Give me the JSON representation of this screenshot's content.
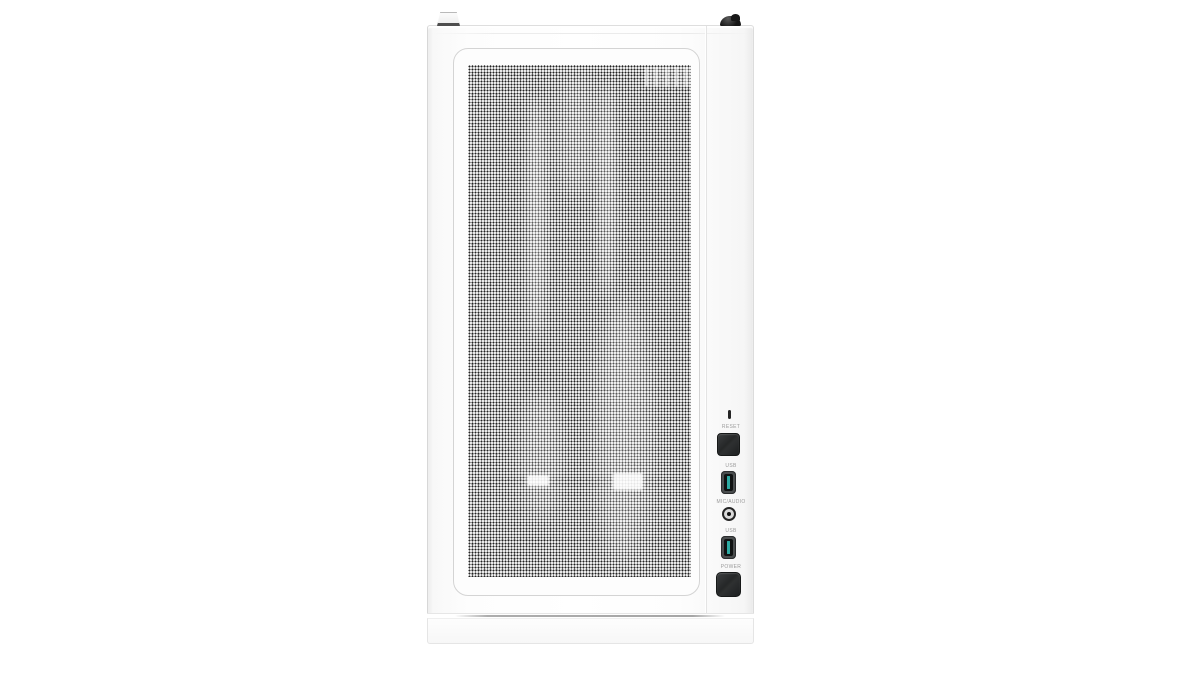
{
  "scene": {
    "type": "product-photo",
    "subject": "White mid-tower PC case, front view, perforated mesh front panel",
    "background_color": "#ffffff"
  },
  "pc_case": {
    "body_color": "#fcfcfc",
    "mesh": {
      "hole_color": "#3c3c3c",
      "base_color": "#f3f3f3",
      "frame_color": "#d4d4d4"
    },
    "top_hardware": {
      "latch": "white release tab",
      "thumbscrew": "black thumbscrew"
    },
    "io_panel": {
      "label_color": "#9b9b9b",
      "button_color": "#2c2e2f",
      "usb_accent_color": "#2caaa2",
      "items": [
        {
          "id": "reset",
          "label": "RESET",
          "type": "push-button"
        },
        {
          "id": "usb-top",
          "label": "USB",
          "type": "usb-port"
        },
        {
          "id": "mic-audio",
          "label": "MIC/AUDIO",
          "type": "audio-jack"
        },
        {
          "id": "usb-bottom",
          "label": "USB",
          "type": "usb-port"
        },
        {
          "id": "power",
          "label": "POWER",
          "type": "push-button"
        }
      ]
    }
  }
}
